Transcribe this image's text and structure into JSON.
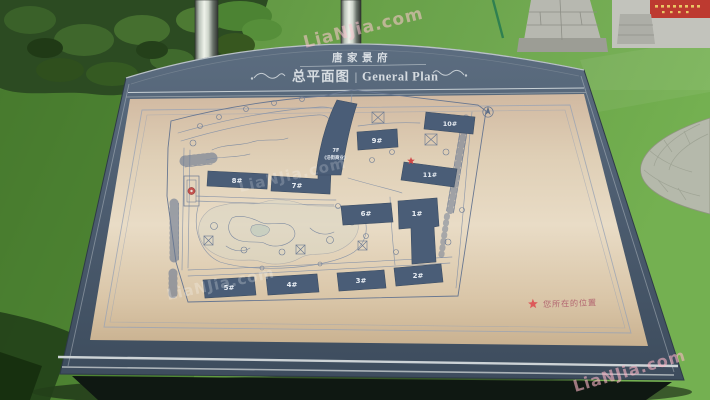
{
  "sign": {
    "project_name": "唐家景府",
    "plan_title_cn": "总平面图",
    "plan_title_divider": "|",
    "plan_title_en": "General Plan",
    "legend": {
      "icon": "star-icon",
      "label": "您所在的位置"
    }
  },
  "map": {
    "buildings": {
      "b1": "1#",
      "b2": "2#",
      "b3": "3#",
      "b4": "4#",
      "b5": "5#",
      "b6": "6#",
      "b7": "7#",
      "b8": "8#",
      "b9": "9#",
      "b10": "10#",
      "b11": "11#"
    },
    "street_commercial": {
      "line1": "7F",
      "line2": "(沿街商业)"
    }
  },
  "watermark": {
    "text": "LiaNJia.com"
  },
  "colors": {
    "board": "#4c5c6f",
    "panel": "#e3d4bc",
    "map_ink": "#5e6e87",
    "building_fill": "#4a5d77",
    "accent_red": "#d05050",
    "grass": "#65a245",
    "banner_red": "#bd3a30",
    "trim_silver": "#c9d0d5"
  }
}
